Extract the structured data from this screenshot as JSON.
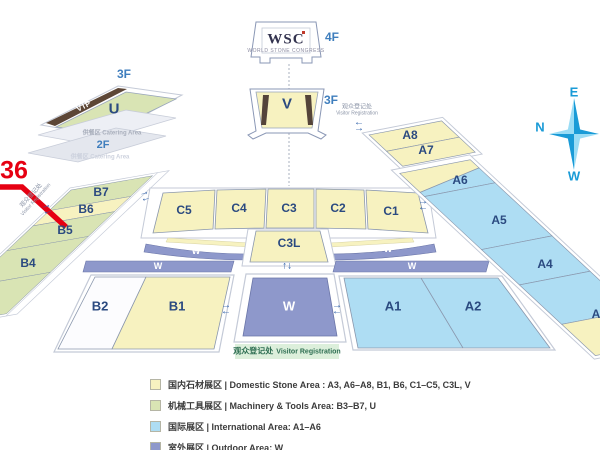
{
  "map": {
    "booth_callout": "36",
    "wsc_building": {
      "logo": "WSC",
      "tagline": "WORLD STONE CONGRESS",
      "floor": "4F"
    },
    "v_hall": {
      "label": "V",
      "floor": "3F"
    },
    "u_hall": {
      "label": "U",
      "floor": "3F",
      "vip": "VIP"
    },
    "catering": {
      "floor": "2F",
      "label_top": "供餐区 Catering Area",
      "label_bottom": "供餐区 Catering Area"
    },
    "halls": {
      "b7": "B7",
      "b6": "B6",
      "b5": "B5",
      "b4": "B4",
      "b2": "B2",
      "b1": "B1",
      "c5": "C5",
      "c4": "C4",
      "c3": "C3",
      "c2": "C2",
      "c1": "C1",
      "c3l": "C3L",
      "a1": "A1",
      "a2": "A2",
      "a3_partial": "A",
      "a4": "A4",
      "a5": "A5",
      "a6": "A6",
      "a7": "A7",
      "a8": "A8"
    },
    "walkway_label": "W",
    "registration": {
      "cn": "观众登记处",
      "en": "Visitor Registration"
    },
    "compass": {
      "top": "E",
      "left": "N",
      "bottom": "W"
    }
  },
  "icons": {
    "arrow_right": "→",
    "arrow_left": "←",
    "arrow_up_down": "↑↓"
  },
  "colors": {
    "domestic_yellow": "#f7f2c0",
    "machinery_green": "#d9e4b4",
    "international_blue": "#aeddf3",
    "outdoor_periwinkle": "#8e98cb",
    "callout_red": "#e60012",
    "compass_blue": "#1a9bd7"
  },
  "legend": {
    "items": [
      {
        "color": "#f7f2c0",
        "label": "国内石材展区 | Domestic Stone Area : A3, A6–A8, B1, B6, C1–C5, C3L, V"
      },
      {
        "color": "#d9e4b4",
        "label": "机械工具展区 | Machinery & Tools Area: B3–B7, U"
      },
      {
        "color": "#aeddf3",
        "label": "国际展区 | International Area: A1–A6"
      },
      {
        "color": "#8e98cb",
        "label": "室外展区 | Outdoor Area: W"
      }
    ]
  }
}
